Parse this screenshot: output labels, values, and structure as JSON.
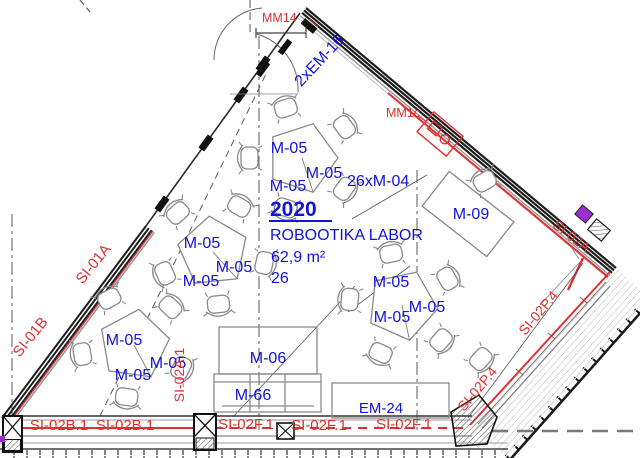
{
  "room": {
    "number": "2020",
    "name": "ROBOOTIKA LABOR",
    "area": "62,9 m²",
    "capacity": "26"
  },
  "furniture": {
    "group_table": "M-05",
    "chairs_count": "26xM-04",
    "desk": "M-09",
    "cabinet": "M-06",
    "sideboard": "M-66",
    "equipment": "EM-24"
  },
  "walls": {
    "left_upper": "SI-01A",
    "left_lower": "SI-01B",
    "bottom_b": "SI-02B.1",
    "bottom_a_vertical": "SI-02A.1",
    "bottom_f": "SI-02F.1",
    "diagonal_p": "SI-02P.4",
    "right_corner": "SI-02A.",
    "top_glazing": "2xEM-16",
    "top_door": "MM14",
    "wall_device": "MM1c"
  },
  "colors": {
    "label_blue": "#1212dd",
    "label_red": "#e03131",
    "line_red": "#e03131",
    "wall_dark": "#1d1d1d",
    "furniture_gray": "#8a8a8a",
    "accent_purple": "#9b2fd0"
  }
}
